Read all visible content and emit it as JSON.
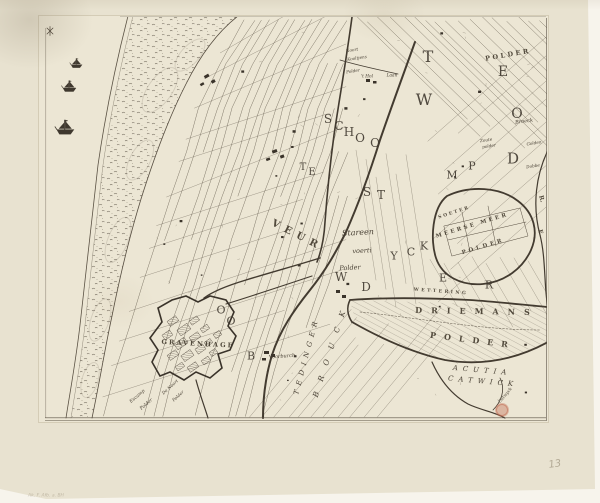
{
  "colors": {
    "background": "#f7f4ec",
    "paper": "#e8e2d0",
    "plate": "#ece6d4",
    "ink": "#4a4136",
    "ink_light": "#6b6152",
    "pencil": "#a09681",
    "stamp_red": "#c06a50"
  },
  "map": {
    "labels": [
      {
        "t": "T",
        "x": 428,
        "y": 57,
        "s": 16,
        "r": 0,
        "st": "cap"
      },
      {
        "t": "W",
        "x": 424,
        "y": 100,
        "s": 16,
        "r": 0,
        "st": "cap"
      },
      {
        "t": "E",
        "x": 503,
        "y": 72,
        "s": 14,
        "r": 0,
        "st": "cap"
      },
      {
        "t": "O",
        "x": 517,
        "y": 114,
        "s": 14,
        "r": 0,
        "st": "cap"
      },
      {
        "t": "D",
        "x": 513,
        "y": 159,
        "s": 15,
        "r": 0,
        "st": "cap"
      },
      {
        "t": "M",
        "x": 452,
        "y": 175,
        "s": 11,
        "r": 0,
        "st": "cap"
      },
      {
        "t": "P",
        "x": 472,
        "y": 166,
        "s": 11,
        "r": 0,
        "st": "cap"
      },
      {
        "t": "S",
        "x": 328,
        "y": 119,
        "s": 12,
        "r": 0,
        "st": "cap"
      },
      {
        "t": "C",
        "x": 339,
        "y": 126,
        "s": 12,
        "r": 0,
        "st": "cap"
      },
      {
        "t": "H",
        "x": 349,
        "y": 132,
        "s": 12,
        "r": 0,
        "st": "cap"
      },
      {
        "t": "O",
        "x": 360,
        "y": 138,
        "s": 12,
        "r": 0,
        "st": "cap"
      },
      {
        "t": "O",
        "x": 375,
        "y": 143,
        "s": 12,
        "r": 0,
        "st": "cap"
      },
      {
        "t": "S",
        "x": 367,
        "y": 192,
        "s": 12,
        "r": 0,
        "st": "cap"
      },
      {
        "t": "T",
        "x": 381,
        "y": 195,
        "s": 12,
        "r": 0,
        "st": "cap"
      },
      {
        "t": "T",
        "x": 303,
        "y": 168,
        "s": 10,
        "r": 0,
        "st": "cap"
      },
      {
        "t": "E",
        "x": 312,
        "y": 173,
        "s": 10,
        "r": 0,
        "st": "cap"
      },
      {
        "t": "Y",
        "x": 394,
        "y": 256,
        "s": 11,
        "r": 0,
        "st": "cap"
      },
      {
        "t": "C",
        "x": 411,
        "y": 252,
        "s": 11,
        "r": 0,
        "st": "cap"
      },
      {
        "t": "K",
        "x": 424,
        "y": 246,
        "s": 11,
        "r": 0,
        "st": "cap"
      },
      {
        "t": "W",
        "x": 341,
        "y": 277,
        "s": 12,
        "r": 0,
        "st": "cap"
      },
      {
        "t": "D",
        "x": 366,
        "y": 287,
        "s": 12,
        "r": 0,
        "st": "cap"
      },
      {
        "t": "O",
        "x": 221,
        "y": 310,
        "s": 11,
        "r": 0,
        "st": "cap"
      },
      {
        "t": "O",
        "x": 231,
        "y": 321,
        "s": 11,
        "r": 0,
        "st": "cap"
      },
      {
        "t": "B",
        "x": 251,
        "y": 356,
        "s": 11,
        "r": 0,
        "st": "cap"
      },
      {
        "t": "E",
        "x": 443,
        "y": 278,
        "s": 11,
        "r": 0,
        "st": "cap"
      },
      {
        "t": "R",
        "x": 489,
        "y": 285,
        "s": 11,
        "r": 0,
        "st": "cap"
      },
      {
        "t": "POLDER",
        "x": 508,
        "y": 55,
        "s": 6.5,
        "r": -10,
        "ls": 2.5,
        "st": "caps"
      },
      {
        "t": "DRIEMANS",
        "x": 477,
        "y": 311,
        "s": 8,
        "r": 1,
        "ls": 9,
        "st": "caps"
      },
      {
        "t": "POLDER",
        "x": 473,
        "y": 340,
        "s": 8,
        "r": 7,
        "ls": 8,
        "st": "caps"
      },
      {
        "t": "WETTERING",
        "x": 441,
        "y": 291,
        "s": 4.5,
        "r": 4,
        "ls": 2.5,
        "st": "caps"
      },
      {
        "t": "SOETER",
        "x": 454,
        "y": 212,
        "s": 4.5,
        "r": -18,
        "ls": 2,
        "st": "caps"
      },
      {
        "t": "MEERSE MEER",
        "x": 472,
        "y": 225,
        "s": 5.5,
        "r": -17,
        "ls": 2.5,
        "st": "caps"
      },
      {
        "t": "POLDER",
        "x": 483,
        "y": 246,
        "s": 5.5,
        "r": -17,
        "ls": 3,
        "st": "caps"
      },
      {
        "t": "GRAVENHAGE",
        "x": 198,
        "y": 344,
        "s": 6.5,
        "r": 3,
        "ls": 2,
        "st": "caps"
      },
      {
        "t": "VEUR",
        "x": 297,
        "y": 236,
        "s": 10,
        "r": 27,
        "ls": 6,
        "st": "caps"
      },
      {
        "t": "TEDINGER",
        "x": 307,
        "y": 356,
        "s": 7,
        "r": -75,
        "ls": 5,
        "st": "icaps"
      },
      {
        "t": "BROUCK",
        "x": 331,
        "y": 349,
        "s": 7.5,
        "r": -72,
        "ls": 11,
        "st": "icaps"
      },
      {
        "t": "ACUTIA",
        "x": 482,
        "y": 371,
        "s": 7,
        "r": 5,
        "ls": 5,
        "st": "icaps"
      },
      {
        "t": "CATWICK",
        "x": 483,
        "y": 382,
        "s": 7,
        "r": 5,
        "ls": 5,
        "st": "icaps"
      },
      {
        "t": "E.",
        "x": 540,
        "y": 233,
        "s": 6,
        "r": 75,
        "st": "caps"
      },
      {
        "t": "R.",
        "x": 541,
        "y": 199,
        "s": 6,
        "r": 75,
        "st": "caps"
      },
      {
        "t": "Stareen",
        "x": 358,
        "y": 233,
        "s": 8,
        "r": -3,
        "st": "it"
      },
      {
        "t": "voerti",
        "x": 362,
        "y": 251,
        "s": 6.5,
        "r": -3,
        "st": "it"
      },
      {
        "t": "Polder",
        "x": 350,
        "y": 268,
        "s": 6.5,
        "r": -3,
        "st": "it"
      },
      {
        "t": "Broeck",
        "x": 524,
        "y": 121,
        "s": 5,
        "r": -8,
        "st": "it"
      },
      {
        "t": "Golden",
        "x": 534,
        "y": 143,
        "s": 4.2,
        "r": -8,
        "st": "it"
      },
      {
        "t": "Dobbe",
        "x": 533,
        "y": 166,
        "s": 4.2,
        "r": -8,
        "st": "it"
      },
      {
        "t": "Zoute",
        "x": 486,
        "y": 140,
        "s": 4.2,
        "r": -8,
        "st": "it"
      },
      {
        "t": "polder",
        "x": 489,
        "y": 146,
        "s": 4.2,
        "r": -8,
        "st": "it"
      },
      {
        "t": "Voorburch",
        "x": 282,
        "y": 356,
        "s": 5,
        "r": -4,
        "st": "it"
      },
      {
        "t": "Catwyck",
        "x": 505,
        "y": 395,
        "s": 4.3,
        "r": -50,
        "st": "it"
      },
      {
        "t": "Laan",
        "x": 392,
        "y": 75,
        "s": 4.3,
        "r": 0,
        "st": "it"
      },
      {
        "t": "'t Hol",
        "x": 367,
        "y": 76,
        "s": 4.3,
        "r": 0,
        "st": "it"
      },
      {
        "t": "Noort",
        "x": 352,
        "y": 50,
        "s": 4.2,
        "r": -8,
        "st": "it"
      },
      {
        "t": "Kooltjens",
        "x": 357,
        "y": 58,
        "s": 4.2,
        "r": -8,
        "st": "it"
      },
      {
        "t": "Polder",
        "x": 353,
        "y": 71,
        "s": 4.2,
        "r": -8,
        "st": "it"
      },
      {
        "t": "Escamp",
        "x": 137,
        "y": 396,
        "s": 4.6,
        "r": -40,
        "st": "it"
      },
      {
        "t": "Polder",
        "x": 146,
        "y": 404,
        "s": 4.6,
        "r": -40,
        "st": "it"
      },
      {
        "t": "De Noort",
        "x": 170,
        "y": 387,
        "s": 4.3,
        "r": -42,
        "st": "it"
      },
      {
        "t": "Polder",
        "x": 178,
        "y": 396,
        "s": 4.3,
        "r": -42,
        "st": "it"
      },
      {
        "t": "13",
        "x": 555,
        "y": 465,
        "s": 10,
        "r": -8,
        "st": "pencil",
        "o": 0.75
      },
      {
        "t": "Ak. F. Afb. a. BH",
        "x": 46,
        "y": 495,
        "s": 4.5,
        "r": 0,
        "st": "pencil",
        "o": 0.55
      }
    ],
    "ships": [
      {
        "x": 77,
        "y": 63,
        "s": 0.85
      },
      {
        "x": 70,
        "y": 86,
        "s": 1.0
      },
      {
        "x": 66,
        "y": 127,
        "s": 1.3
      }
    ],
    "stamp": {
      "x": 502,
      "y": 410,
      "r": 7,
      "color": "#c06a50"
    }
  }
}
